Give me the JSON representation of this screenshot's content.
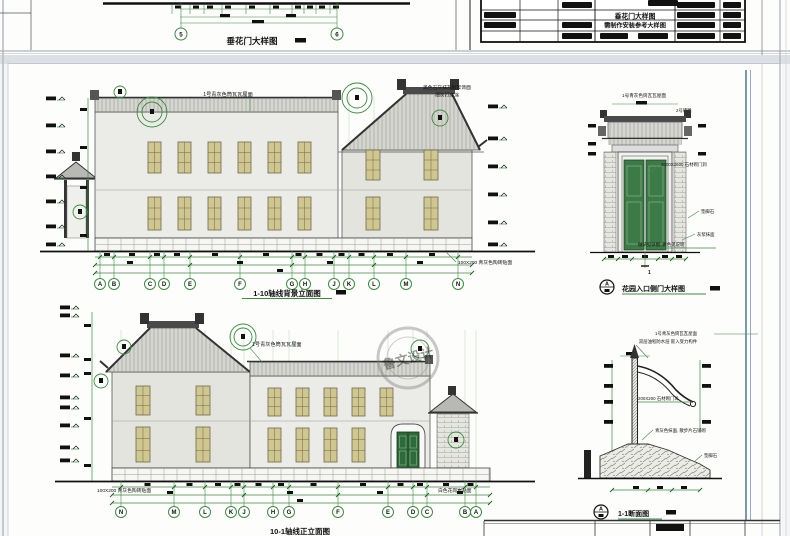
{
  "top_sheet": {
    "caption": "垂花门大样图",
    "grid_bubbles": [
      "5",
      "6"
    ],
    "title_block": {
      "title_line1": "垂花门大样图",
      "title_line2": "需制作安装参考大样图"
    }
  },
  "main_sheet": {
    "watermark_text": "鲁文设计",
    "elev_top": {
      "roof_label": "1号青灰色筒瓦瓦屋面",
      "gable_label1": "黑色石灰抹灰砂浆饰面",
      "gable_label2": "细灰打底涂",
      "base_label_right": "100X200 青灰色陶砖贴面",
      "caption": "1-10轴线背景立面图",
      "grid_letters": [
        "A",
        "B",
        "C",
        "D",
        "E",
        "F",
        "G",
        "H",
        "J",
        "K",
        "L",
        "M",
        "N"
      ]
    },
    "elev_bottom": {
      "roof_label": "1号青灰色筒瓦瓦屋面",
      "base_label_left": "100X200 青灰色陶砖贴面",
      "base_label_right": "白色花岗岩贴面",
      "caption": "10-1轴线正立面图",
      "grid_letters": [
        "N",
        "M",
        "L",
        "K",
        "J",
        "H",
        "G",
        "F",
        "E",
        "D",
        "C",
        "B",
        "A"
      ]
    },
    "detail_gate": {
      "label_roof": "1号青灰色筒瓦瓦屋面",
      "label_brick": "2号砖雕",
      "label_opening": "2000X2600 石材砌门洞",
      "label_stone": "垫脚石",
      "label_plaster": "灰浆抹面",
      "label_note": "做法见详图, 颜色见说明",
      "section_mark": "1",
      "bubble": "A",
      "caption": "花园入口侧门大样图"
    },
    "detail_section": {
      "label_top1": "1号青灰色筒瓦瓦屋面",
      "label_top2": "双层油毡防水层 嵌入受力构件",
      "label_pier": "200X200 石材砌门垛",
      "label_apron": "青灰色抹面, 散步片石铺砌",
      "label_stone": "垫脚石",
      "bubble": "A",
      "caption": "1-1断面图"
    }
  }
}
